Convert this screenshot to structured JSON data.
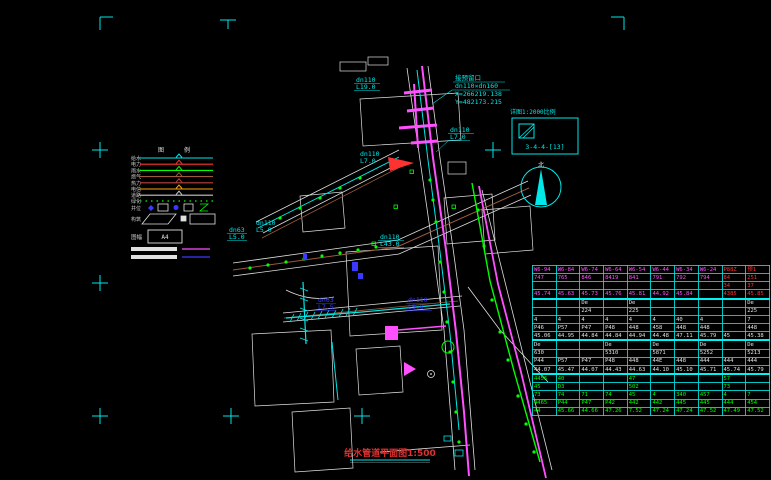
{
  "colors": {
    "cyan": "#00e8e8",
    "magenta": "#ff50ff",
    "green": "#00ff00",
    "red": "#ff3232",
    "blue": "#3a3aff",
    "brown": "#9c5a3c",
    "orange": "#ffa500",
    "white": "#e0e0e0",
    "maroon": "#c04040",
    "gray": "#c8c8c8",
    "title_red": "#e03030"
  },
  "title": {
    "text": "给水管道平面图",
    "scale": "1:500"
  },
  "annotation": {
    "line1": "接预留口",
    "line2": "dn110×dn160",
    "line3": "X=266219.138",
    "line4": "Y=482173.215"
  },
  "index_box": {
    "label": "详图1:2000比例",
    "code": "3-4-4-[13]"
  },
  "north": {
    "label": "北"
  },
  "legend": {
    "header1": "图",
    "header2": "例",
    "rows": [
      {
        "label": "给水",
        "color": "#00e8e8"
      },
      {
        "label": "电力",
        "color": "#ff3232"
      },
      {
        "label": "雨水",
        "color": "#00ff00"
      },
      {
        "label": "燃气",
        "color": "#9c5a3c"
      },
      {
        "label": "热力",
        "color": "#c04040"
      },
      {
        "label": "电信",
        "color": "#ffa500"
      },
      {
        "label": "道路",
        "color": "#c8c8c8"
      }
    ],
    "dotted_label": "绿化",
    "symbols_label": "井位",
    "shapes_label": "构筑",
    "frame_label": "图幅",
    "frame_code": "A4"
  },
  "drawing": {
    "labels": [
      {
        "l1": "dn110",
        "l2": "L19.0",
        "color": "#00e8e8"
      },
      {
        "l1": "dn110",
        "l2": "L7.0",
        "color": "#00e8e8"
      },
      {
        "l1": "dn110",
        "l2": "L7.0",
        "color": "#00e8e8"
      },
      {
        "l1": "dn110",
        "l2": "L5.0",
        "color": "#00e8e8"
      },
      {
        "l1": "dn63",
        "l2": "L5.0",
        "color": "#00e8e8"
      },
      {
        "l1": "dn110",
        "l2": "L43.0",
        "color": "#00e8e8"
      },
      {
        "l1": "dn63",
        "l2": "L7.5",
        "color": "#3a3aff"
      },
      {
        "l1": "dn110",
        "l2": "L5.0",
        "color": "#3a3aff"
      }
    ]
  },
  "table": {
    "rows": [
      {
        "color": "m",
        "red_from": 8,
        "cells": [
          "W6-94",
          "W6-84",
          "W6-74",
          "W6-64",
          "W6-54",
          "W6-44",
          "W6-34",
          "W6-24",
          "P88Z",
          "预1"
        ]
      },
      {
        "color": "m",
        "red_from": 8,
        "cells": [
          "747",
          "765",
          "846",
          "8419",
          "841",
          "791",
          "792",
          "794",
          "84",
          "251"
        ]
      },
      {
        "color": "m",
        "red_from": 8,
        "cells": [
          "",
          "",
          "",
          "",
          "",
          "",
          "",
          "",
          "34",
          "37"
        ]
      },
      {
        "color": "m",
        "red_from": 8,
        "sep": true,
        "cells": [
          "45.74",
          "45.63",
          "45.73",
          "45.76",
          "45.81",
          "44.92",
          "45.84",
          "",
          "4385",
          "45.85"
        ]
      },
      {
        "color": "w",
        "cells": [
          "",
          "",
          "De",
          "",
          "De",
          "",
          "",
          "",
          "",
          "De"
        ]
      },
      {
        "color": "w",
        "cells": [
          "",
          "",
          "224",
          "",
          "225",
          "",
          "",
          "",
          "",
          "225"
        ]
      },
      {
        "color": "w",
        "cells": [
          "4",
          "4",
          "4",
          "4",
          "4",
          "4",
          "40",
          "4",
          "",
          "7"
        ]
      },
      {
        "color": "w",
        "cells": [
          "P46",
          "P57",
          "P47",
          "P48",
          "448",
          "458",
          "448",
          "448",
          "",
          "448"
        ]
      },
      {
        "color": "w",
        "sep": true,
        "cells": [
          "45.06",
          "44.95",
          "44.84",
          "44.84",
          "44.94",
          "44.48",
          "47.11",
          "45.79",
          "45",
          "45.38"
        ]
      },
      {
        "color": "w",
        "cells": [
          "De",
          "",
          "",
          "De",
          "",
          "De",
          "",
          "De",
          "",
          "De"
        ]
      },
      {
        "color": "w",
        "cells": [
          "630",
          "",
          "",
          "5310",
          "",
          "5871",
          "",
          "5252",
          "",
          "5213"
        ]
      },
      {
        "color": "w",
        "cells": [
          "P44",
          "P57",
          "P47",
          "P48",
          "448",
          "44E",
          "448",
          "444",
          "444",
          "444"
        ]
      },
      {
        "color": "w",
        "sep": true,
        "cells": [
          "44.07",
          "45.47",
          "44.07",
          "44.43",
          "44.63",
          "44.10",
          "45.10",
          "45.71",
          "45.74",
          "45.79"
        ]
      },
      {
        "color": "g",
        "cells": [
          "4456",
          "40",
          "",
          "",
          "47",
          "",
          "",
          "",
          "57",
          ""
        ]
      },
      {
        "color": "g",
        "cells": [
          "45",
          "D3",
          "",
          "",
          "502",
          "",
          "",
          "",
          "73",
          ""
        ]
      },
      {
        "color": "g",
        "cells": [
          "73",
          "74",
          "71",
          "74",
          "45",
          "4",
          "340",
          "457",
          "4",
          "7"
        ]
      },
      {
        "color": "g",
        "cells": [
          "4465",
          "P44",
          "P47",
          "P42",
          "442",
          "442",
          "445",
          "445",
          "444",
          "454"
        ]
      },
      {
        "color": "g",
        "cells": [
          "44",
          "45.66",
          "44.66",
          "47.26",
          "7.52",
          "47.24",
          "47.24",
          "47.52",
          "47.49",
          "47.52"
        ]
      }
    ]
  }
}
